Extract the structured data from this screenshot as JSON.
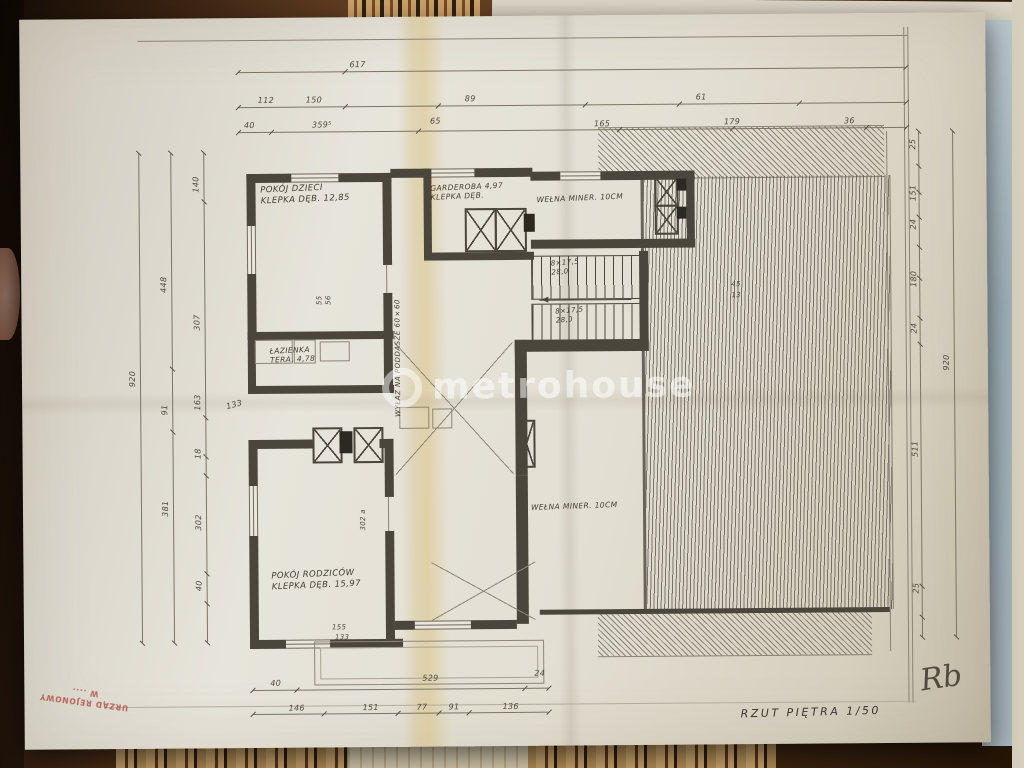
{
  "watermark": {
    "text": "metrohouse"
  },
  "stamp": {
    "line1": "URZĄD REJONOWY",
    "line2": "W ...."
  },
  "footer": {
    "title": "RZUT PIĘTRA 1/50",
    "signature": "Rb"
  },
  "rooms": {
    "pokoj_dzieci_1": "POKÓJ DZIECI",
    "pokoj_dzieci_2": "KLEPKA DĘB. 12,85",
    "garderoba_1": "GARDEROBA 4,97",
    "garderoba_2": "KLEPKA DĘB.",
    "welna_top": "WEŁNA MINER. 10CM",
    "welna_mid": "WEŁNA MINER. 10CM",
    "wylaz": "WYŁAZ NA PODDASZE 60×60",
    "lazienka_1": "ŁAZIENKA",
    "lazienka_2": "TERA. 4,78",
    "pokoj_rodzicow_1": "POKÓJ RODZICÓW",
    "pokoj_rodzicow_2": "KLEPKA DĘB. 15,97",
    "stairs_a1": "8×17,5",
    "stairs_a2": "28,0",
    "stairs_b1": "8×17,5",
    "stairs_b2": "28,0"
  },
  "dims": {
    "top_total": "617",
    "top2": [
      "112",
      "150",
      "89",
      "61"
    ],
    "top3": [
      "40",
      "359⁵",
      "165",
      "179",
      "36"
    ],
    "t65": "65",
    "left_total": "920",
    "left_mid": [
      "448",
      "91",
      "381"
    ],
    "left_inner": [
      "140",
      "307",
      "163",
      "18",
      "302",
      "40"
    ],
    "l133": "133",
    "right_chain": [
      "25",
      "151",
      "24",
      "180",
      "24",
      "511",
      "25"
    ],
    "right_total": "920",
    "bottom1": [
      "40",
      "529",
      "24"
    ],
    "bottom2": [
      "146",
      "151",
      "77",
      "91",
      "136"
    ],
    "b_extra": [
      "155",
      "133"
    ],
    "s55": "55",
    "s56": "56",
    "s45": "45",
    "s13": "13",
    "a302": "302 a"
  }
}
